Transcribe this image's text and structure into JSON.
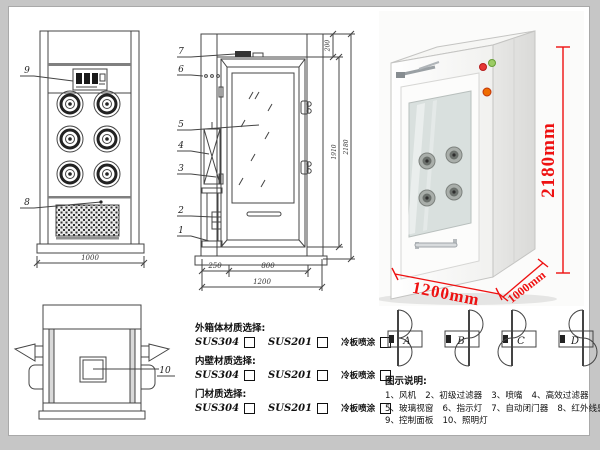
{
  "front_view": {
    "callout_control_panel": "9",
    "callout_grille": "8",
    "dim_width": "1000"
  },
  "side_view": {
    "callouts": [
      "7",
      "6",
      "5",
      "4",
      "3",
      "2",
      "1"
    ],
    "dim_top": "200",
    "dim_door_height": "1910",
    "dim_total_height": "2180",
    "dim_left": "250",
    "dim_door_width": "800",
    "dim_total_width": "1200"
  },
  "top_view": {
    "callout": "10"
  },
  "photo": {
    "dim_height": "2180mm",
    "dim_width": "1200mm",
    "dim_depth": "1000mm",
    "dim_color": "#ee1111",
    "indicator_colors": {
      "red": "#e53935",
      "green": "#9ccc65",
      "orange": "#ef6c00"
    }
  },
  "materials": {
    "rows": [
      {
        "label": "外箱体材质选择:",
        "options": [
          "SUS304",
          "SUS201",
          "冷板喷涂"
        ]
      },
      {
        "label": "内壁材质选择:",
        "options": [
          "SUS304",
          "SUS201",
          "冷板喷涂"
        ]
      },
      {
        "label": "门材质选择:",
        "options": [
          "SUS304",
          "SUS201",
          "冷板喷涂"
        ]
      }
    ]
  },
  "door_options": {
    "labels": [
      "A",
      "B",
      "C",
      "D"
    ]
  },
  "legend": {
    "title": "图示说明:",
    "items": [
      "1、风机",
      "2、初级过滤器",
      "3、喷嘴",
      "4、高效过滤器",
      "5、玻璃视窗",
      "6、指示灯",
      "7、自动闭门器",
      "8、红外线感应器",
      "9、控制面板",
      "10、照明灯"
    ]
  }
}
